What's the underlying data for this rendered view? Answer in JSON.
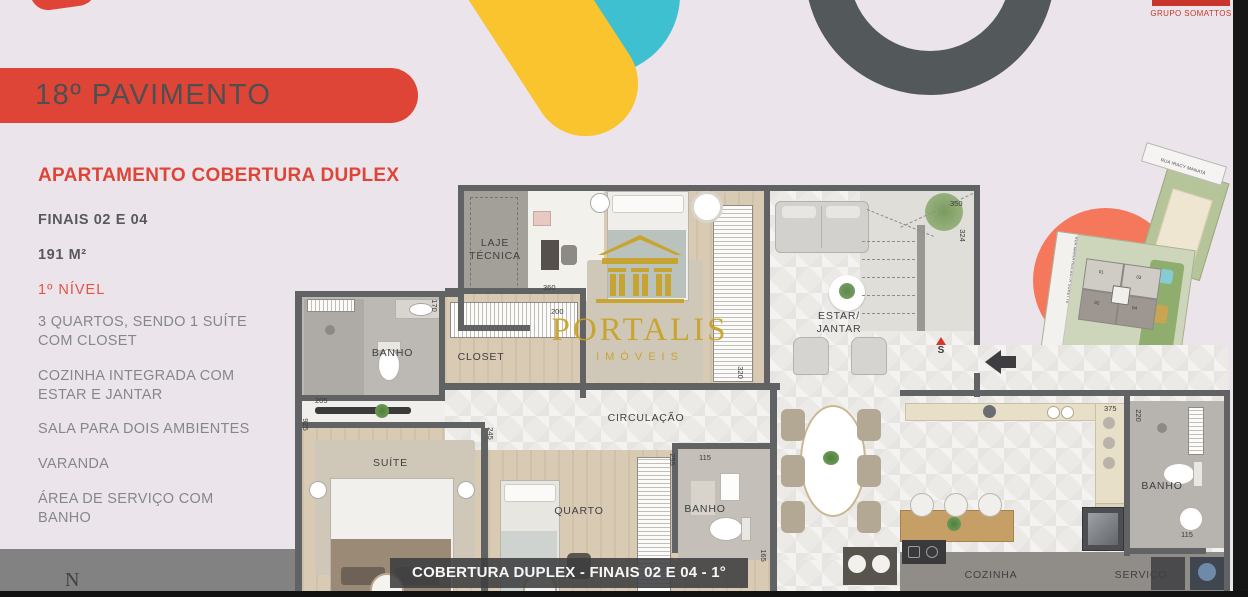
{
  "brand": {
    "name": "GRUPO SOMATTOS"
  },
  "header": {
    "floor_title": "18º PAVIMENTO"
  },
  "details": {
    "title": "APARTAMENTO COBERTURA DUPLEX",
    "units": "FINAIS 02 E 04",
    "area": "191 M²",
    "level": "1º NÍVEL",
    "features": [
      "3 QUARTOS, SENDO 1 SUÍTE\nCOM CLOSET",
      "COZINHA INTEGRADA COM\nESTAR E JANTAR",
      "SALA PARA DOIS AMBIENTES",
      "VARANDA",
      "ÁREA DE SERVIÇO COM\nBANHO"
    ]
  },
  "watermark": {
    "name": "PORTALIS",
    "tagline": "IMÓVEIS"
  },
  "floorplan": {
    "caption": "COBERTURA DUPLEX - FINAIS 02 E 04 - 1° NIVEL",
    "compass": "N",
    "stair_label": "S",
    "room_labels": [
      {
        "id": "laje-tecnica",
        "text": "LAJE\nTÉCNICA",
        "x": 160,
        "y": 52,
        "w": 80
      },
      {
        "id": "banho-suite",
        "text": "BANHO",
        "x": 60,
        "y": 162,
        "w": 75
      },
      {
        "id": "closet",
        "text": "CLOSET",
        "x": 150,
        "y": 166,
        "w": 72
      },
      {
        "id": "suite",
        "text": "SUÍTE",
        "x": 58,
        "y": 272,
        "w": 75
      },
      {
        "id": "quarto",
        "text": "QUARTO",
        "x": 246,
        "y": 320,
        "w": 76
      },
      {
        "id": "banho-quarto",
        "text": "BANHO",
        "x": 372,
        "y": 318,
        "w": 76
      },
      {
        "id": "circulacao",
        "text": "CIRCULAÇÃO",
        "x": 305,
        "y": 227,
        "w": 92
      },
      {
        "id": "estar-jantar",
        "text": "ESTAR/\nJANTAR",
        "x": 505,
        "y": 125,
        "w": 78
      },
      {
        "id": "banho-servico",
        "text": "BANHO",
        "x": 828,
        "y": 295,
        "w": 78
      },
      {
        "id": "cozinha",
        "text": "COZINHA",
        "x": 656,
        "y": 384,
        "w": 80
      },
      {
        "id": "servico",
        "text": "SERVIÇO",
        "x": 806,
        "y": 384,
        "w": 80
      }
    ],
    "dimensions": [
      {
        "value": "350",
        "x": 655,
        "y": 14,
        "rot": 0
      },
      {
        "value": "324",
        "x": 661,
        "y": 46,
        "rot": 1
      },
      {
        "value": "360",
        "x": 248,
        "y": 98,
        "rot": 0
      },
      {
        "value": "200",
        "x": 256,
        "y": 122,
        "rot": 0
      },
      {
        "value": "170",
        "x": 133,
        "y": 116,
        "rot": 1
      },
      {
        "value": "320",
        "x": 439,
        "y": 183,
        "rot": 1
      },
      {
        "value": "205",
        "x": 20,
        "y": 211,
        "rot": 0
      },
      {
        "value": "925",
        "x": 4,
        "y": 235,
        "rot": 1
      },
      {
        "value": "245",
        "x": 189,
        "y": 244,
        "rot": 1
      },
      {
        "value": "255",
        "x": 371,
        "y": 270,
        "rot": 1
      },
      {
        "value": "115",
        "x": 404,
        "y": 268,
        "rot": 0
      },
      {
        "value": "165",
        "x": 462,
        "y": 366,
        "rot": 1
      },
      {
        "value": "375",
        "x": 809,
        "y": 219,
        "rot": 0
      },
      {
        "value": "220",
        "x": 837,
        "y": 226,
        "rot": 1
      },
      {
        "value": "115",
        "x": 886,
        "y": 345,
        "rot": 0
      }
    ]
  },
  "siteplan": {
    "street_top": "RUA IRACY MANATA",
    "street_left": "RUA MARIA HEILBUTH SURETTE",
    "unit_labels": [
      "01",
      "03",
      "02",
      "04"
    ]
  }
}
